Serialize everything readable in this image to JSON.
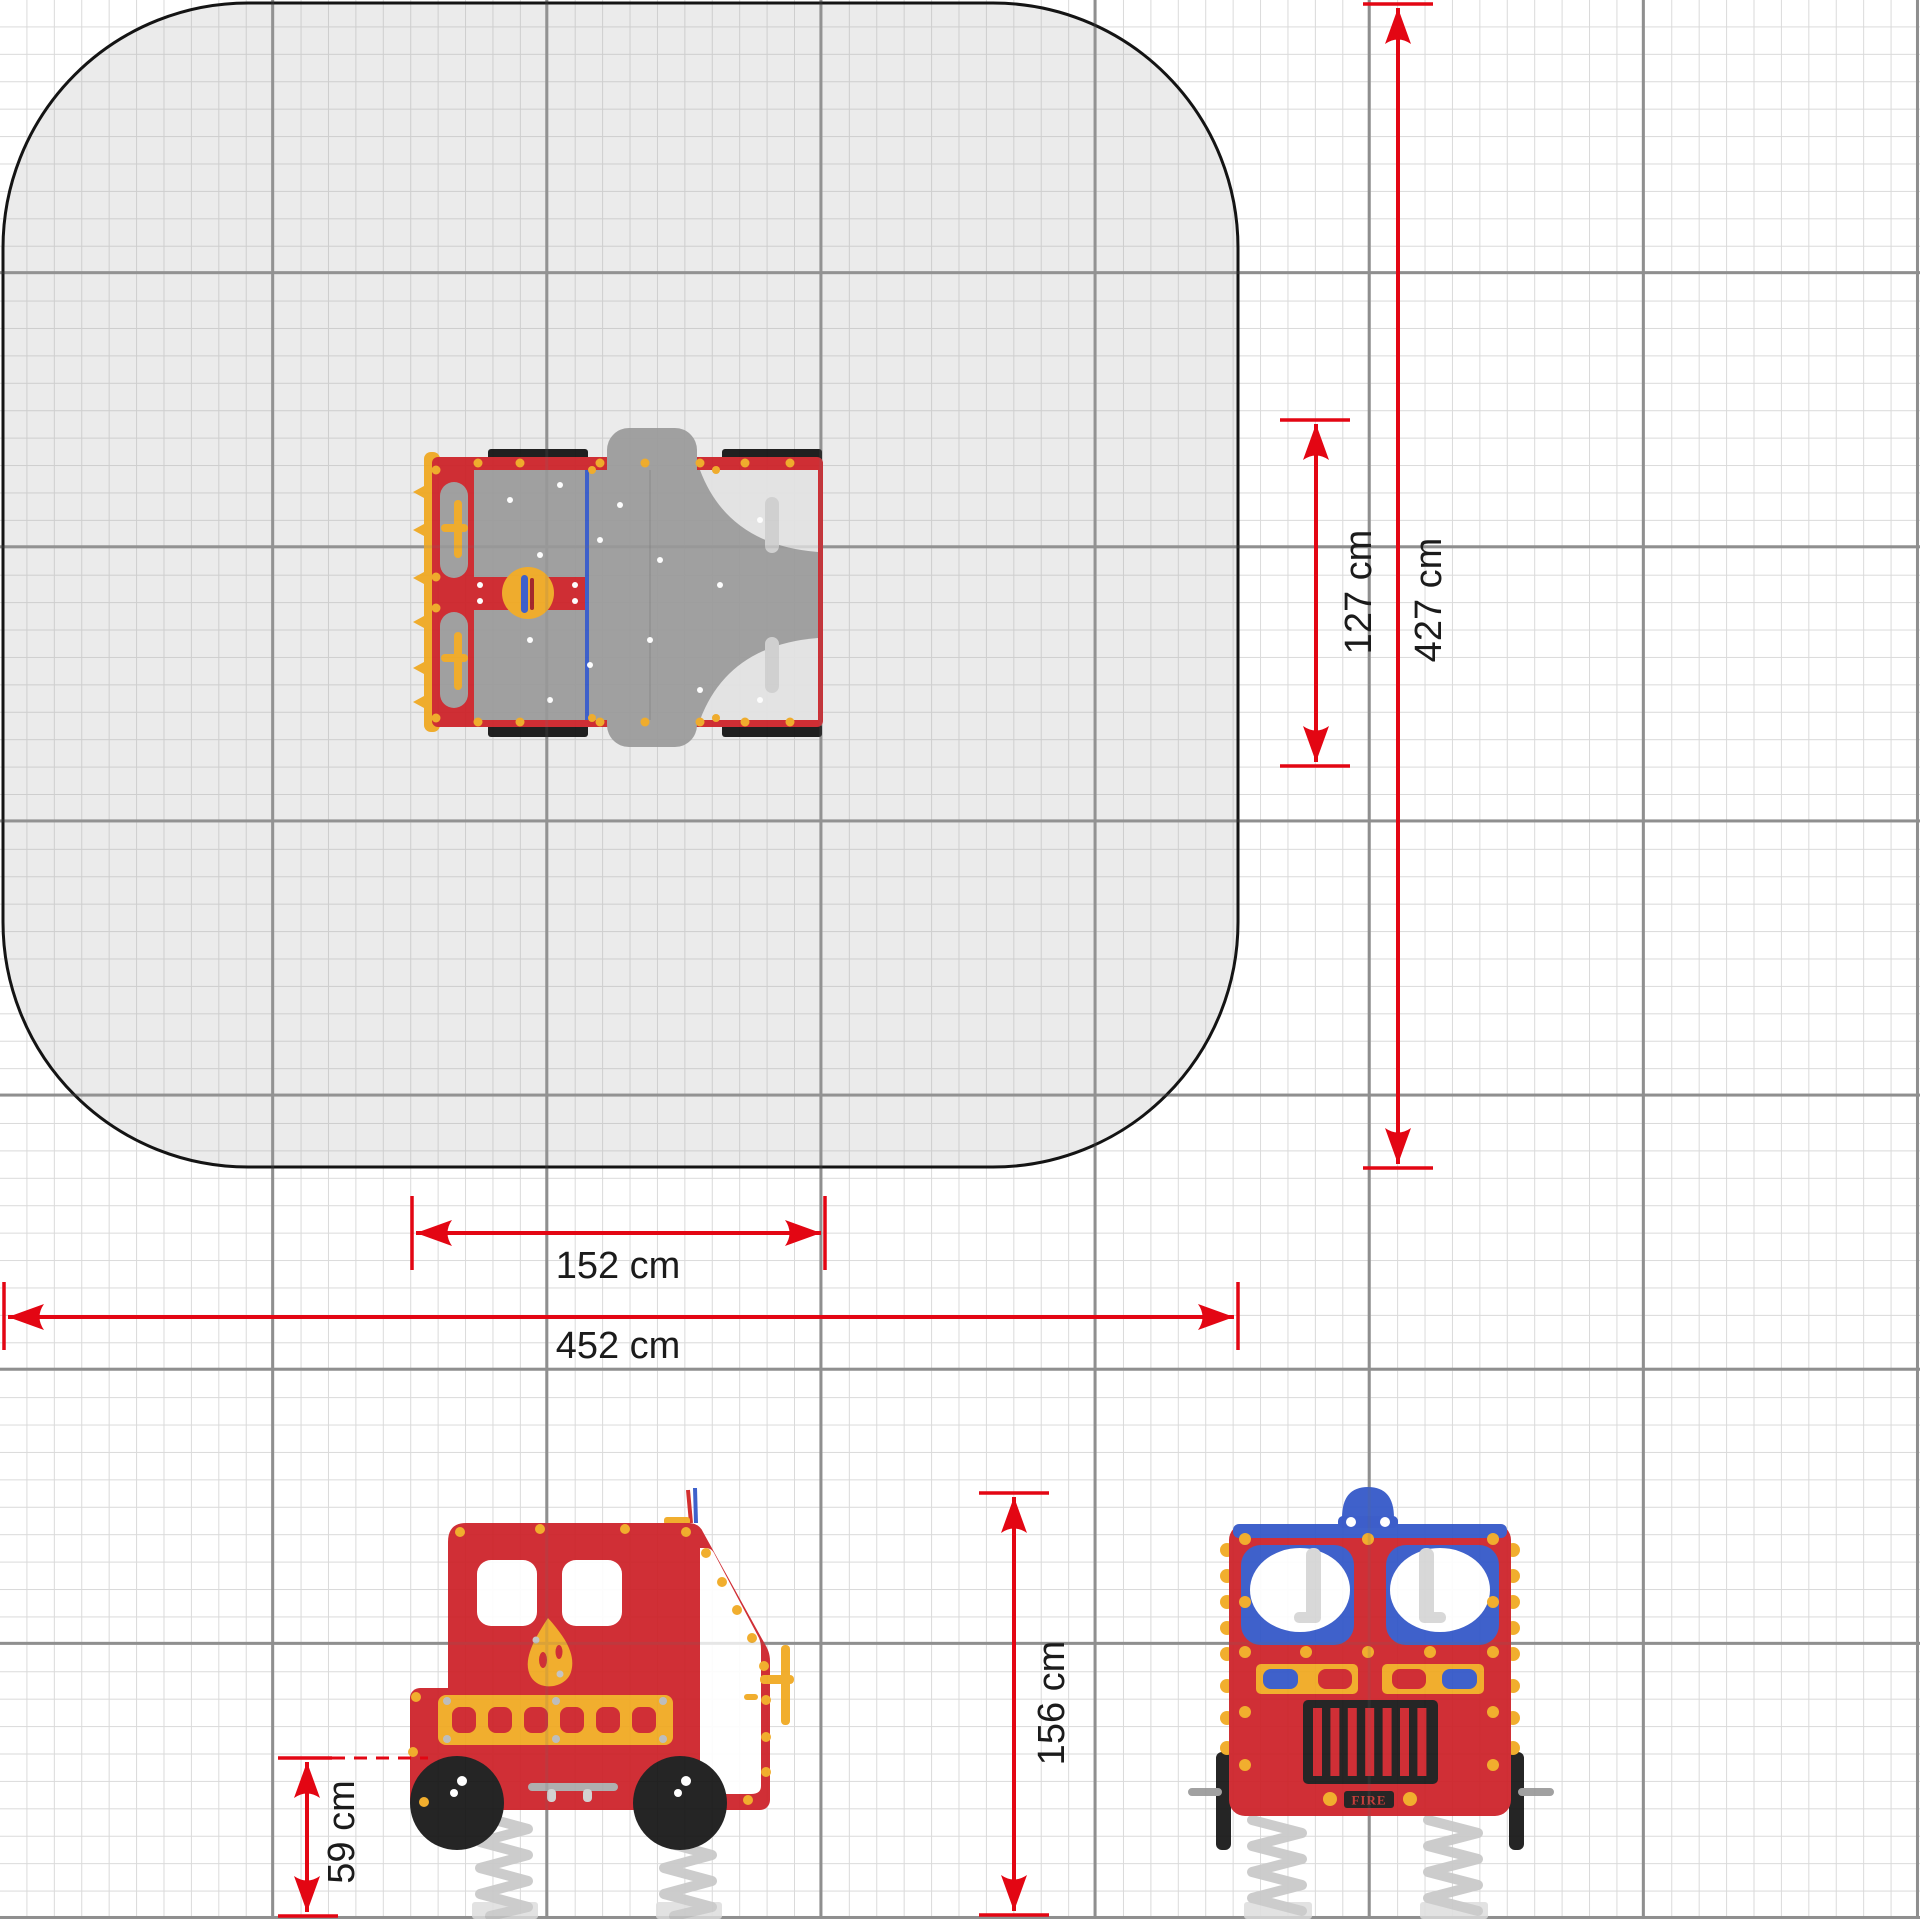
{
  "diagram": {
    "subject": "fire-truck-spring-rider-installation-drawing",
    "dimensions": {
      "equipment_width": "152 cm",
      "safety_zone_width": "452 cm",
      "equipment_depth": "127 cm",
      "safety_zone_depth": "427 cm",
      "overall_height": "156 cm",
      "seat_height": "59 cm"
    },
    "plate_text": "FIRE",
    "colors": {
      "dimension_red": "#e30613",
      "truck_red": "#cd2027",
      "accent_yellow": "#f0a81f",
      "accent_blue": "#3156c8",
      "deck_gray": "#9b9b9b",
      "safety_zone_fill": "#e9e9e9",
      "grid_minor": "#dadada",
      "grid_major": "#8f8f8f",
      "wheel_black": "#151515",
      "spring_gray": "#c9c9c9"
    }
  }
}
